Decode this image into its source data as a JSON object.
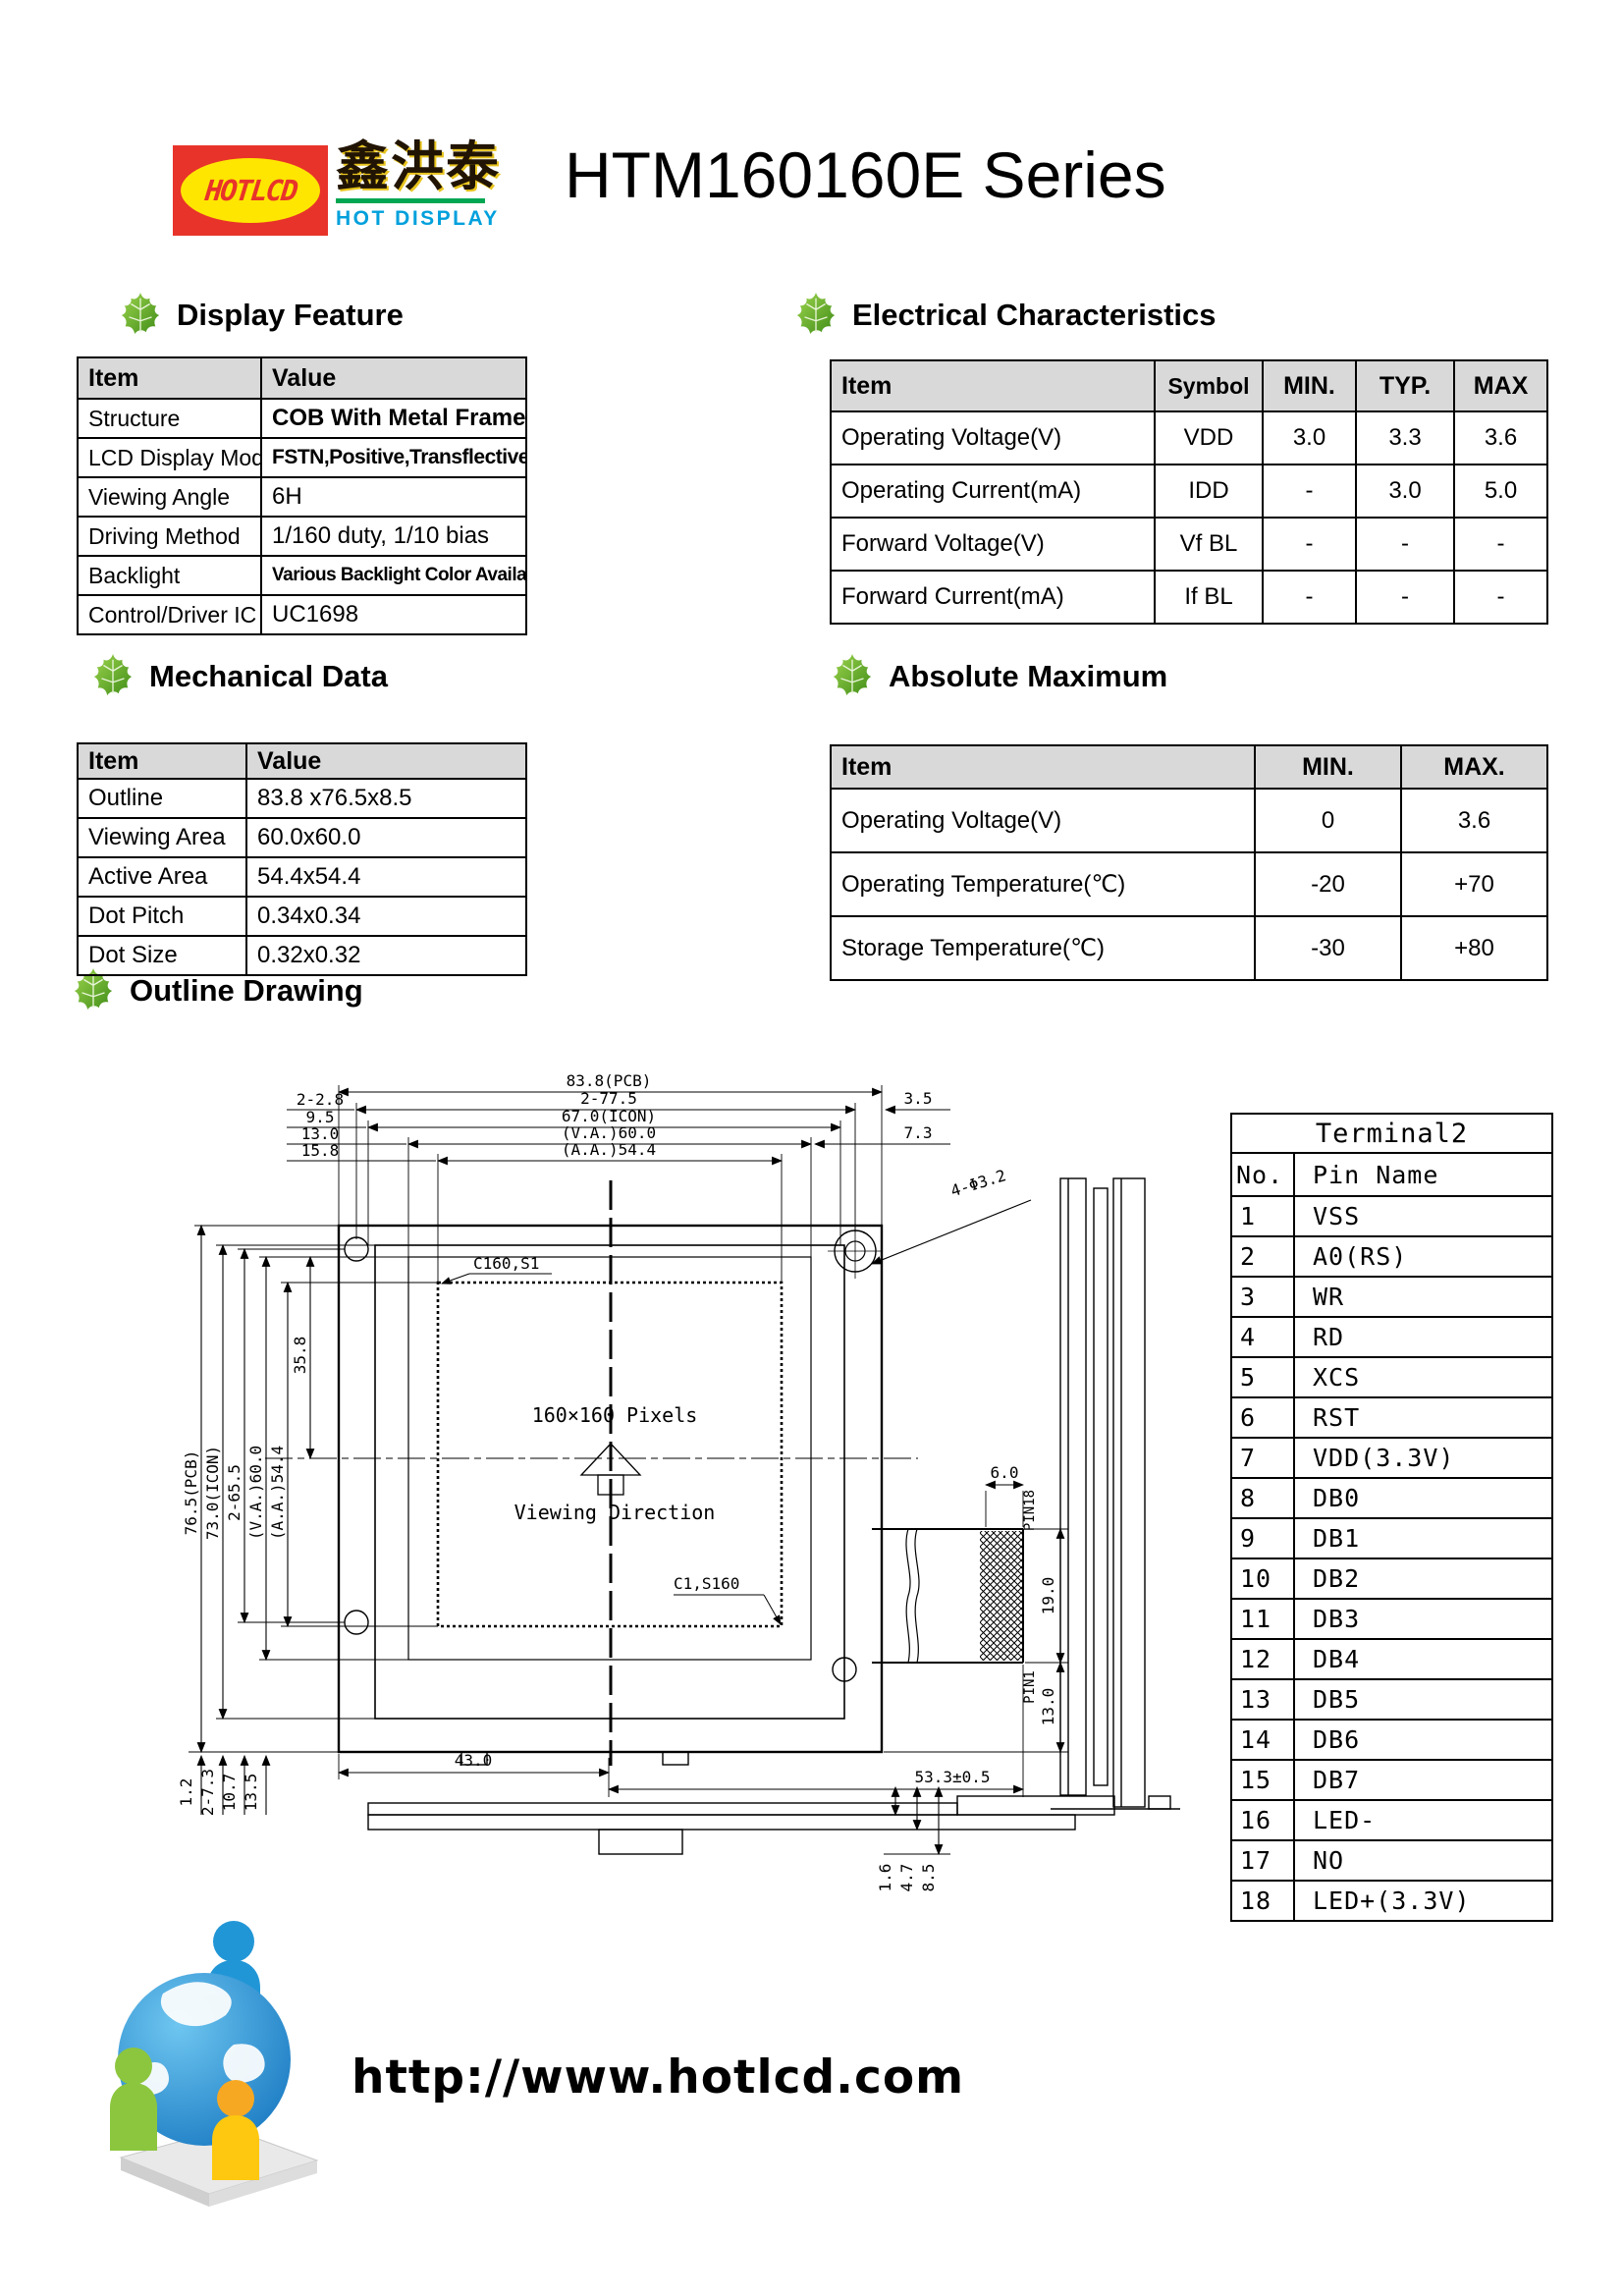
{
  "header": {
    "logo_brand": "HOTLCD",
    "logo_chinese": "鑫洪泰",
    "logo_subtitle": "HOT DISPLAY",
    "title": "HTM160160E Series"
  },
  "display_feature": {
    "title": "Display Feature",
    "headers": [
      "Item",
      "Value"
    ],
    "rows": [
      [
        "Structure",
        "COB With Metal Frame"
      ],
      [
        "LCD Display Mode",
        "FSTN,Positive,Transflective"
      ],
      [
        "Viewing Angle",
        "6H"
      ],
      [
        "Driving Method",
        "1/160 duty, 1/10 bias"
      ],
      [
        "Backlight",
        "Various Backlight Color Available"
      ],
      [
        "Control/Driver IC",
        "UC1698"
      ]
    ]
  },
  "electrical": {
    "title": "Electrical Characteristics",
    "headers": [
      "Item",
      "Symbol",
      "MIN.",
      "TYP.",
      "MAX"
    ],
    "rows": [
      [
        "Operating Voltage(V)",
        "VDD",
        "3.0",
        "3.3",
        "3.6"
      ],
      [
        "Operating Current(mA)",
        "IDD",
        "-",
        "3.0",
        "5.0"
      ],
      [
        "Forward Voltage(V)",
        "Vf BL",
        "-",
        "-",
        "-"
      ],
      [
        "Forward Current(mA)",
        "If BL",
        "-",
        "-",
        "-"
      ]
    ]
  },
  "mechanical": {
    "title": "Mechanical Data",
    "headers": [
      "Item",
      "Value"
    ],
    "rows": [
      [
        "Outline",
        "83.8 x76.5x8.5"
      ],
      [
        "Viewing Area",
        "60.0x60.0"
      ],
      [
        "Active Area",
        "54.4x54.4"
      ],
      [
        "Dot Pitch",
        "0.34x0.34"
      ],
      [
        "Dot Size",
        "0.32x0.32"
      ]
    ]
  },
  "absolute_maximum": {
    "title": "Absolute Maximum",
    "headers": [
      "Item",
      "MIN.",
      "MAX."
    ],
    "rows": [
      [
        "Operating Voltage(V)",
        "0",
        "3.6"
      ],
      [
        "Operating Temperature(℃)",
        "-20",
        "+70"
      ],
      [
        "Storage Temperature(℃)",
        "-30",
        "+80"
      ]
    ]
  },
  "outline": {
    "title": "Outline Drawing",
    "dims": {
      "top_right_labels": [
        "83.8(PCB)",
        "2-77.5",
        "67.0(ICON)",
        "(V.A.)60.0",
        "(A.A.)54.4"
      ],
      "top_left_labels": [
        "2-2.8",
        "9.5",
        "13.0",
        "15.8"
      ],
      "right_labels": [
        "3.5",
        "7.3"
      ],
      "hole_callout": "4-Φ3.2",
      "left_labels": [
        "76.5(PCB)",
        "73.0(ICON)",
        "2-65.5",
        "(V.A.)60.0",
        "(A.A.)54.4"
      ],
      "inner_vertical": "35.8",
      "bottom_left_labels": [
        "1.2",
        "2-7.3",
        "10.7",
        "13.5"
      ],
      "fpc_width": "6.0",
      "pin_top": "PIN18",
      "fpc_height": "19.0",
      "pin_bottom": "PIN1",
      "fpc_offset": "13.0",
      "fpc_total": "53.3±0.5",
      "bottom_width": "43.0",
      "thickness": [
        "1.6",
        "4.7",
        "8.5"
      ]
    },
    "labels": {
      "pixels": "160×160 Pixels",
      "viewing_direction": "Viewing Direction",
      "corner_top": "C160,S1",
      "corner_bottom": "C1,S160"
    },
    "terminal": {
      "title": "Terminal2",
      "headers": [
        "No.",
        "Pin Name"
      ],
      "rows": [
        [
          "1",
          "VSS"
        ],
        [
          "2",
          "A0(RS)"
        ],
        [
          "3",
          "WR"
        ],
        [
          "4",
          "RD"
        ],
        [
          "5",
          "XCS"
        ],
        [
          "6",
          "RST"
        ],
        [
          "7",
          "VDD(3.3V)"
        ],
        [
          "8",
          "DB0"
        ],
        [
          "9",
          "DB1"
        ],
        [
          "10",
          "DB2"
        ],
        [
          "11",
          "DB3"
        ],
        [
          "12",
          "DB4"
        ],
        [
          "13",
          "DB5"
        ],
        [
          "14",
          "DB6"
        ],
        [
          "15",
          "DB7"
        ],
        [
          "16",
          "LED-"
        ],
        [
          "17",
          "NO"
        ],
        [
          "18",
          "LED+(3.3V)"
        ]
      ]
    }
  },
  "footer": {
    "url": "http://www.hotlcd.com"
  }
}
